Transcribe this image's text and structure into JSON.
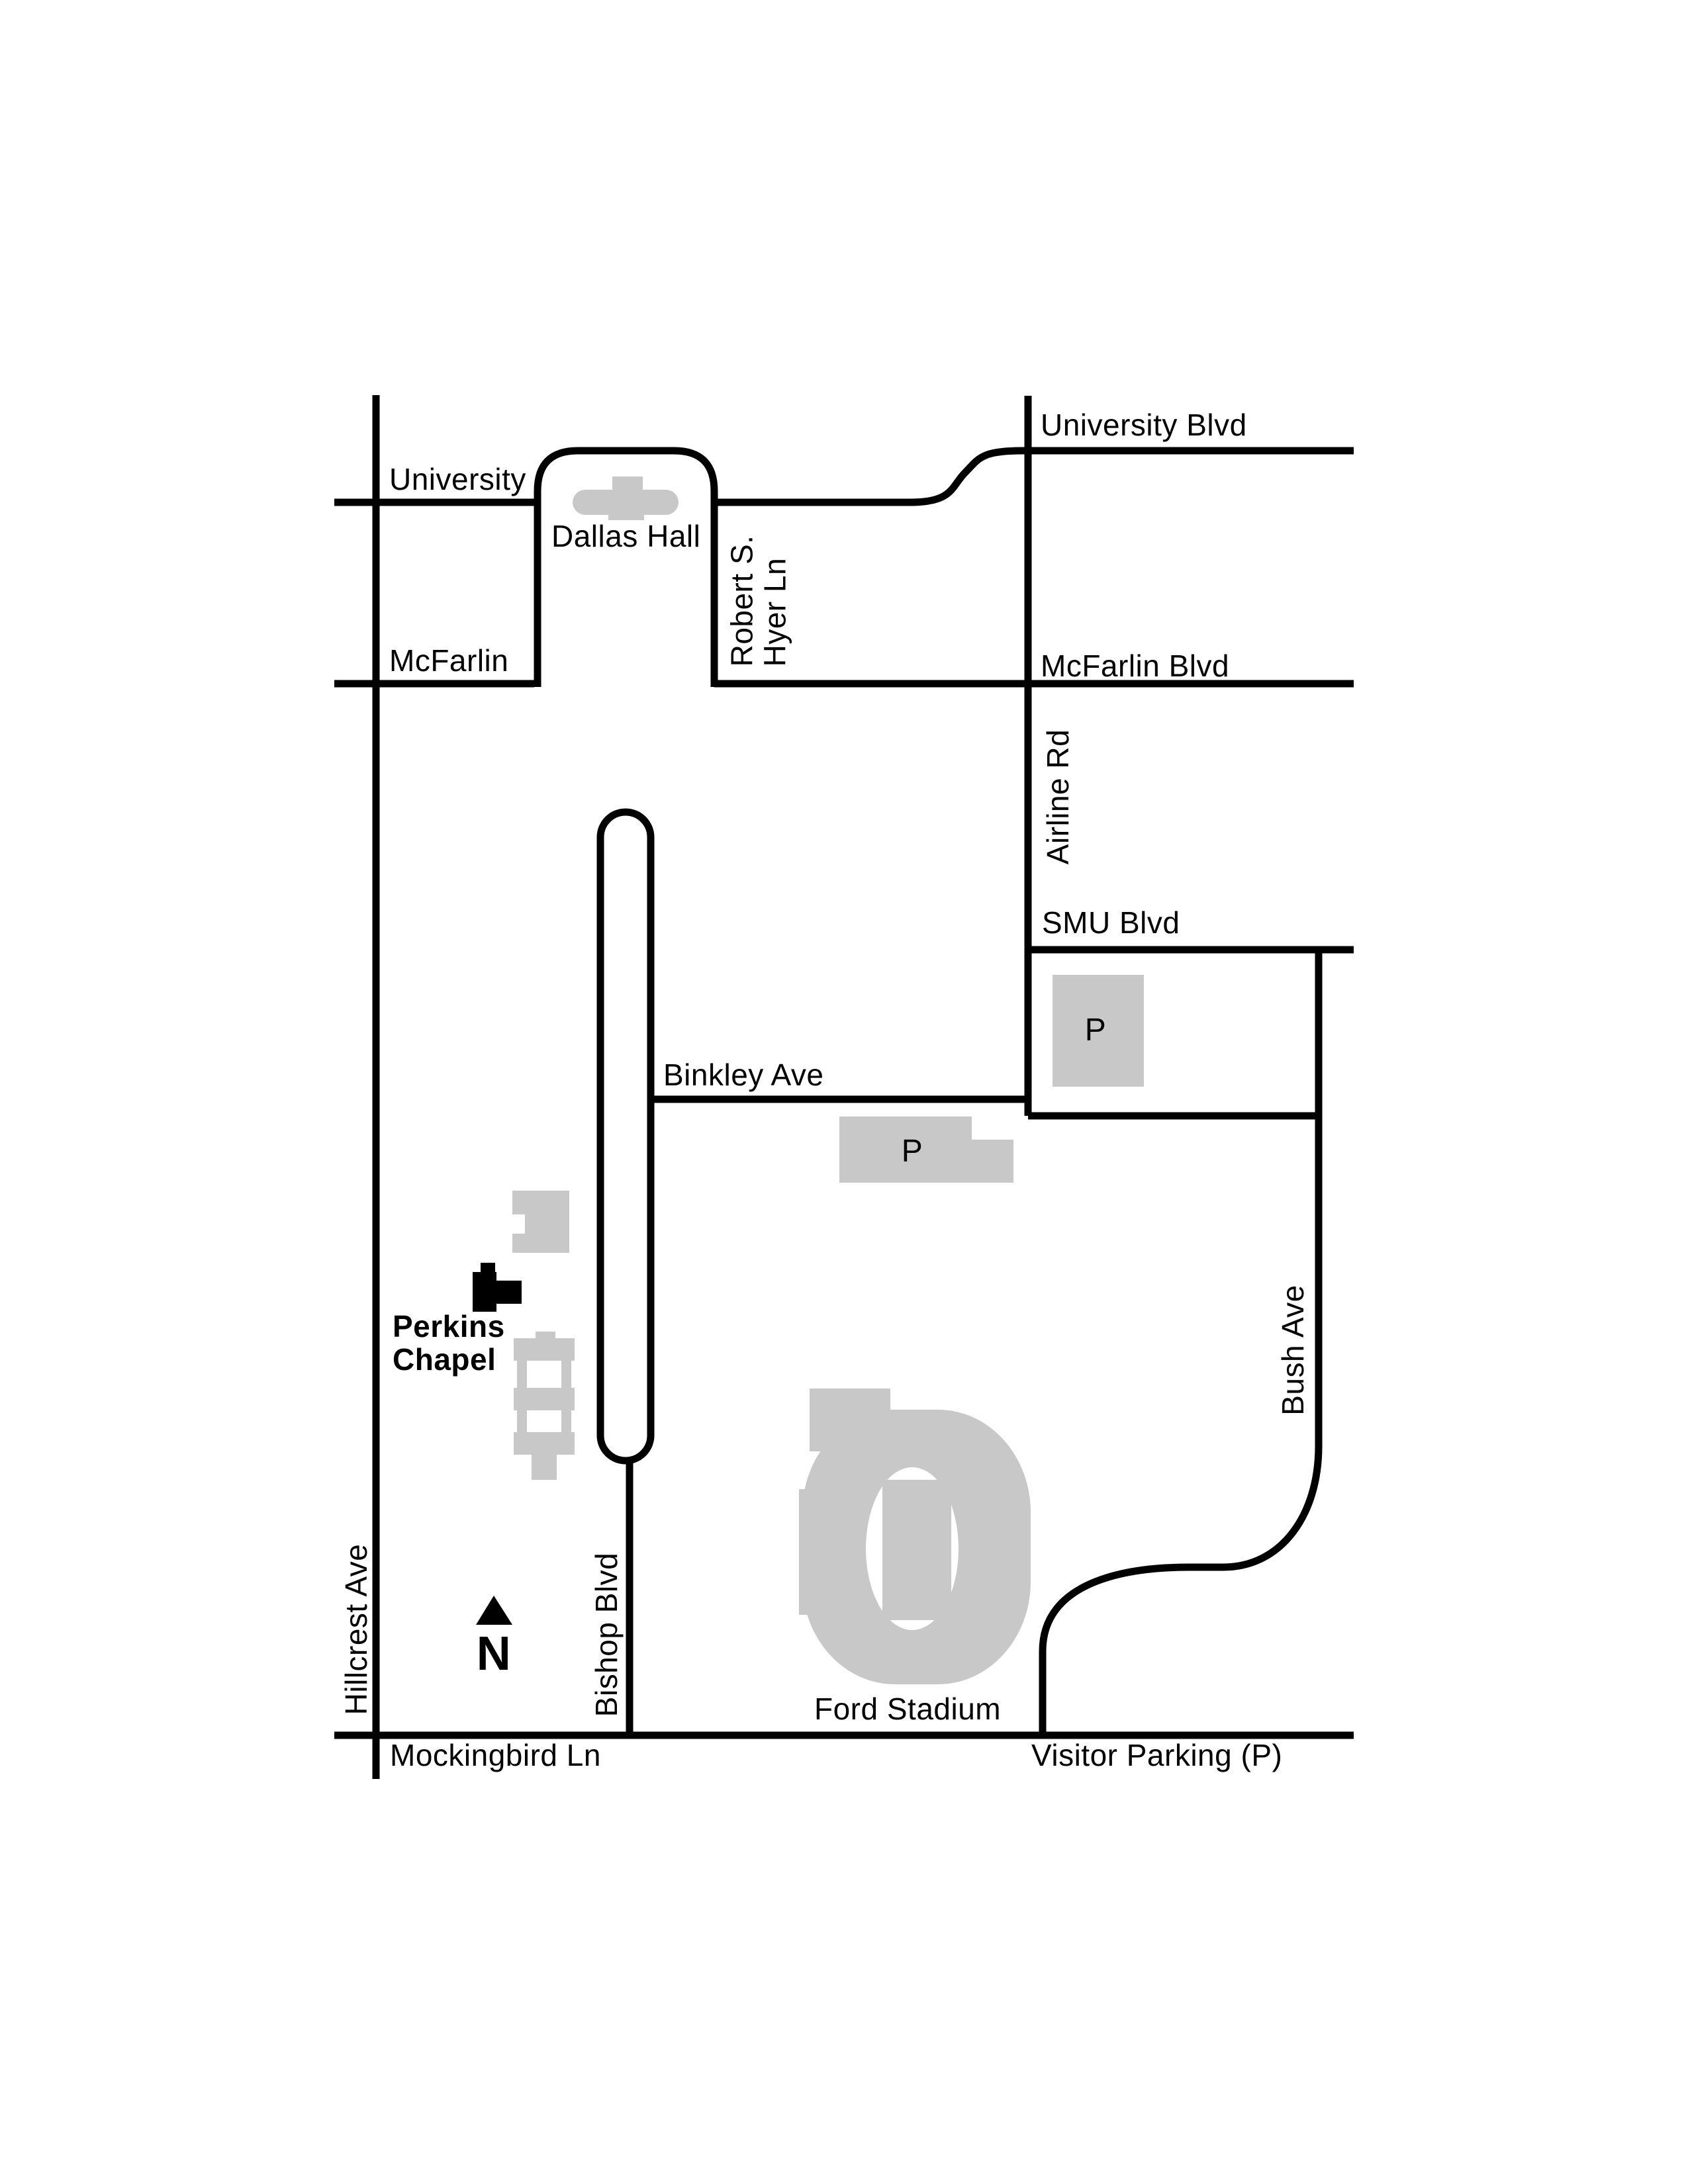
{
  "map": {
    "type": "campus-street-map",
    "campus": "SMU area street map",
    "colors": {
      "road": "#000000",
      "building": "#c8c8c8",
      "chapel_building": "#000000",
      "background": "#ffffff",
      "text": "#000000"
    },
    "streets": {
      "university_blvd": "University Blvd",
      "university": "University",
      "mcfarlin": "McFarlin",
      "mcfarlin_blvd": "McFarlin Blvd",
      "robert_s_hyer_line1": "Robert S.",
      "robert_s_hyer_line2": "Hyer Ln",
      "airline_rd": "Airline Rd",
      "smu_blvd": "SMU Blvd",
      "binkley_ave": "Binkley Ave",
      "bush_ave": "Bush Ave",
      "hillcrest_ave": "Hillcrest Ave",
      "bishop_blvd": "Bishop Blvd",
      "mockingbird_ln": "Mockingbird Ln"
    },
    "places": {
      "dallas_hall": "Dallas Hall",
      "perkins_chapel_line1": "Perkins",
      "perkins_chapel_line2": "Chapel",
      "ford_stadium": "Ford Stadium"
    },
    "parking": {
      "lot_north_label": "P",
      "lot_south_label": "P",
      "legend": "Visitor Parking (P)"
    },
    "compass": {
      "north_label": "N"
    }
  }
}
